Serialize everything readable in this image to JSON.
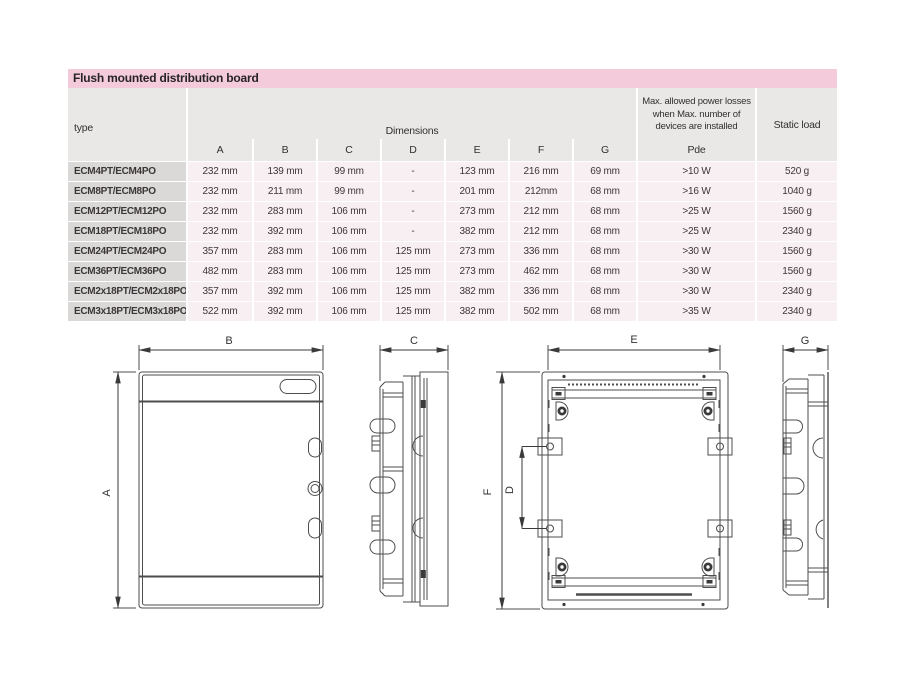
{
  "page": {
    "title": "Flush mounted distribution board"
  },
  "table": {
    "type_header": "type",
    "dimensions_header": "Dimensions",
    "dim_columns": [
      "A",
      "B",
      "C",
      "D",
      "E",
      "F",
      "G"
    ],
    "power_header": "Max. allowed power losses when Max. number of devices are installed",
    "power_subheader": "Pde",
    "static_header": "Static load",
    "rows": [
      {
        "type": "ECM4PT/ECM4PO",
        "values": [
          "232 mm",
          "139 mm",
          "99 mm",
          "-",
          "123 mm",
          "216 mm",
          "69 mm",
          ">10 W",
          "520 g"
        ]
      },
      {
        "type": "ECM8PT/ECM8PO",
        "values": [
          "232 mm",
          "211 mm",
          "99 mm",
          "-",
          "201 mm",
          "212mm",
          "68 mm",
          ">16 W",
          "1040 g"
        ]
      },
      {
        "type": "ECM12PT/ECM12PO",
        "values": [
          "232 mm",
          "283 mm",
          "106 mm",
          "-",
          "273 mm",
          "212 mm",
          "68 mm",
          ">25 W",
          "1560 g"
        ]
      },
      {
        "type": "ECM18PT/ECM18PO",
        "values": [
          "232 mm",
          "392 mm",
          "106 mm",
          "-",
          "382 mm",
          "212 mm",
          "68 mm",
          ">25 W",
          "2340 g"
        ]
      },
      {
        "type": "ECM24PT/ECM24PO",
        "values": [
          "357 mm",
          "283 mm",
          "106 mm",
          "125 mm",
          "273 mm",
          "336 mm",
          "68 mm",
          ">30 W",
          "1560 g"
        ]
      },
      {
        "type": "ECM36PT/ECM36PO",
        "values": [
          "482 mm",
          "283 mm",
          "106 mm",
          "125 mm",
          "273 mm",
          "462 mm",
          "68 mm",
          ">30 W",
          "1560 g"
        ]
      },
      {
        "type": "ECM2x18PT/ECM2x18PO",
        "values": [
          "357 mm",
          "392 mm",
          "106 mm",
          "125 mm",
          "382 mm",
          "336 mm",
          "68 mm",
          ">30 W",
          "2340 g"
        ]
      },
      {
        "type": "ECM3x18PT/ECM3x18PO",
        "values": [
          "522 mm",
          "392 mm",
          "106 mm",
          "125 mm",
          "382 mm",
          "502 mm",
          "68 mm",
          ">35 W",
          "2340 g"
        ]
      }
    ]
  },
  "drawings": {
    "front": {
      "horizontal": "B",
      "vertical": "A"
    },
    "side_left": {
      "horizontal": "C"
    },
    "rear": {
      "horizontal": "E",
      "vertical": "F",
      "inner": "D"
    },
    "side_right": {
      "horizontal": "G"
    }
  },
  "colors": {
    "accent_pink": "#f3cbdb",
    "header_gray": "#eae7e7",
    "type_cell_gray": "#dbd8d8",
    "row_pink": "#f8eff2"
  }
}
